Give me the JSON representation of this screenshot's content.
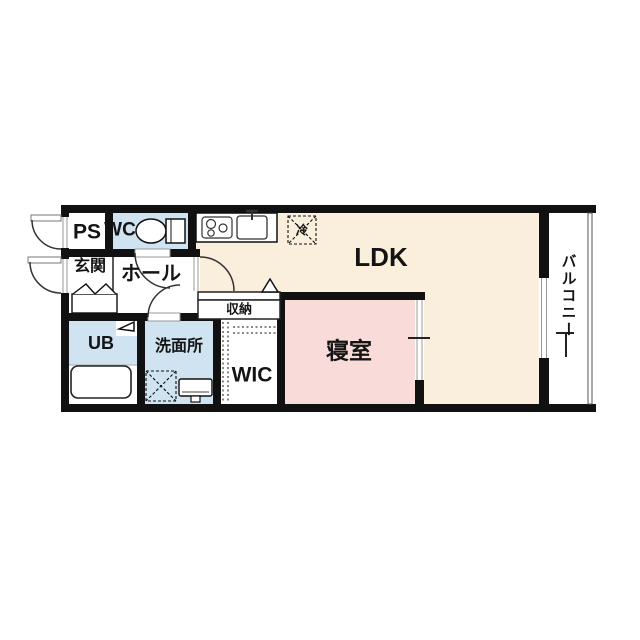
{
  "floor_plan": {
    "rooms": {
      "ps": {
        "label": "PS"
      },
      "wc": {
        "label": "WC"
      },
      "entrance": {
        "label": "玄関"
      },
      "hall": {
        "label": "ホール"
      },
      "unit_bath": {
        "label": "UB"
      },
      "washroom": {
        "label": "洗面所"
      },
      "storage": {
        "label": "収納"
      },
      "wic": {
        "label": "WIC"
      },
      "bedroom": {
        "label": "寝室"
      },
      "ldk": {
        "label": "LDK"
      },
      "balcony": {
        "label": "バルコニー"
      }
    },
    "fixtures": {
      "refrigerator": {
        "label": "冷"
      }
    },
    "colors": {
      "wall": "#111111",
      "ldk_fill": "#faeedc",
      "bedroom_fill": "#f9dcda",
      "wet_area_fill": "#cfe3f1",
      "background": "#ffffff"
    }
  }
}
